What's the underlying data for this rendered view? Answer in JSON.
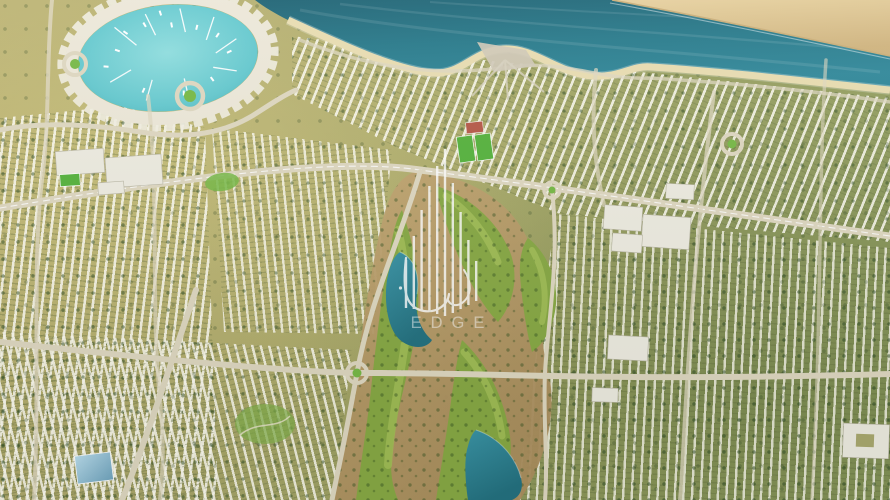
{
  "watermark": {
    "brand": "EDGE",
    "icon": "tower-bars-logo"
  },
  "colors": {
    "sea": "#26798a",
    "sea_deep": "#1c6172",
    "marina_water": "#63c8ce",
    "marina_water_light": "#8eddde",
    "sand_bar": "#e0c892",
    "sand_bar_dark": "#c9ad77",
    "beach": "#e8dcb0",
    "road": "#ded7c0",
    "golf_green": "#87a844",
    "golf_light": "#a3bf57",
    "field_green": "#55b23c",
    "park_green": "#76b845",
    "desert": "#b89a68",
    "lake": "#2d7f92",
    "tree": "#33511f",
    "building_white": "#edebe0",
    "building_shadow": "#b9b6a4",
    "glass_blue": "#8fbdd4",
    "roof_red": "#b55847",
    "watermark_white": "#ffffff"
  }
}
